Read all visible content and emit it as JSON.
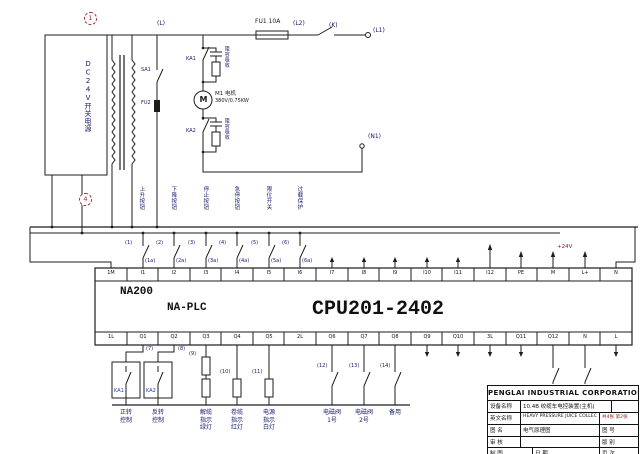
{
  "colors": {
    "line": "#1c1c1c",
    "label_blue": "#15166b",
    "accent_red": "#8b1a1a",
    "relay_blue": "#1a3fae"
  },
  "callouts": {
    "top": "1",
    "mid": "4"
  },
  "power": {
    "supply": "DC24V开关电源",
    "wire_l": "(L)",
    "fuse1": "FU1 10A",
    "wire_l2": "(L2)",
    "switch_k": "(K)",
    "wire_l1": "(L1)",
    "wire_n1": "(N1)",
    "switch_sa": "SA1",
    "fuse2": "FU2"
  },
  "motor": {
    "m": "M",
    "name": "M1 电机",
    "spec": "380V/0.75KW",
    "ka1": "KA1",
    "ka2": "KA2",
    "rc1": "阻容吸收",
    "rc2": "阻容吸收"
  },
  "inputs": {
    "device_labels": [
      "上升按钮",
      "下降按钮",
      "停止按钮",
      "急停按钮",
      "限位开关",
      "过载保护"
    ],
    "wire_labels": [
      "(1)",
      "(2)",
      "(3)",
      "(4)",
      "(5)",
      "(6)"
    ],
    "terminal_wire_labels": [
      "(1a)",
      "(2a)",
      "(3a)",
      "(4a)",
      "(5a)",
      "(6a)"
    ]
  },
  "plc": {
    "brand": "NA200",
    "series": "NA-PLC",
    "cpu": "CPU201-2402",
    "power_label": "+24V",
    "top_terminals": [
      "1M",
      "I1",
      "I2",
      "I3",
      "I4",
      "I5",
      "I6",
      "I7",
      "I8",
      "I9",
      "I10",
      "I11",
      "I12",
      "PE",
      "M",
      "L+",
      "N"
    ],
    "bottom_terminals": [
      "1L",
      "Q1",
      "Q2",
      "Q3",
      "Q4",
      "Q5",
      "2L",
      "Q6",
      "Q7",
      "Q8",
      "Q9",
      "Q10",
      "3L",
      "Q11",
      "Q12",
      "N",
      "L"
    ]
  },
  "outputs": {
    "wire_labels": [
      "(7)",
      "(8)",
      "(9)",
      "(10)",
      "(11)",
      "(12)",
      "(13)",
      "(14)"
    ],
    "relay1": "KA1",
    "relay2": "KA2",
    "device_labels": [
      "正转\n控制",
      "反转\n控制",
      "解缆\n指示\n绿灯",
      "卷缆\n指示\n红灯",
      "电源\n指示\n白灯",
      "电磁阀\n1号",
      "电磁阀\n2号",
      "备用"
    ]
  },
  "titleblock": {
    "company": "PENGLAI INDUSTRIAL CORPORATION LIMITED",
    "device_label": "设备名称",
    "device_value": "10.4B 绞缆车电控装置(主机)",
    "en_label": "英文名称",
    "en_value": "HEAVY PRESSURE JUICE COLLEC",
    "sheet_info": "共4张 第2张",
    "drawing_label": "图 名",
    "drawing_value": "电气原理图",
    "number_label": "图 号",
    "check_label": "审 核",
    "version_label": "版 别",
    "draft_label": "制 图",
    "date_label": "日 期",
    "page_label": "页 次"
  }
}
